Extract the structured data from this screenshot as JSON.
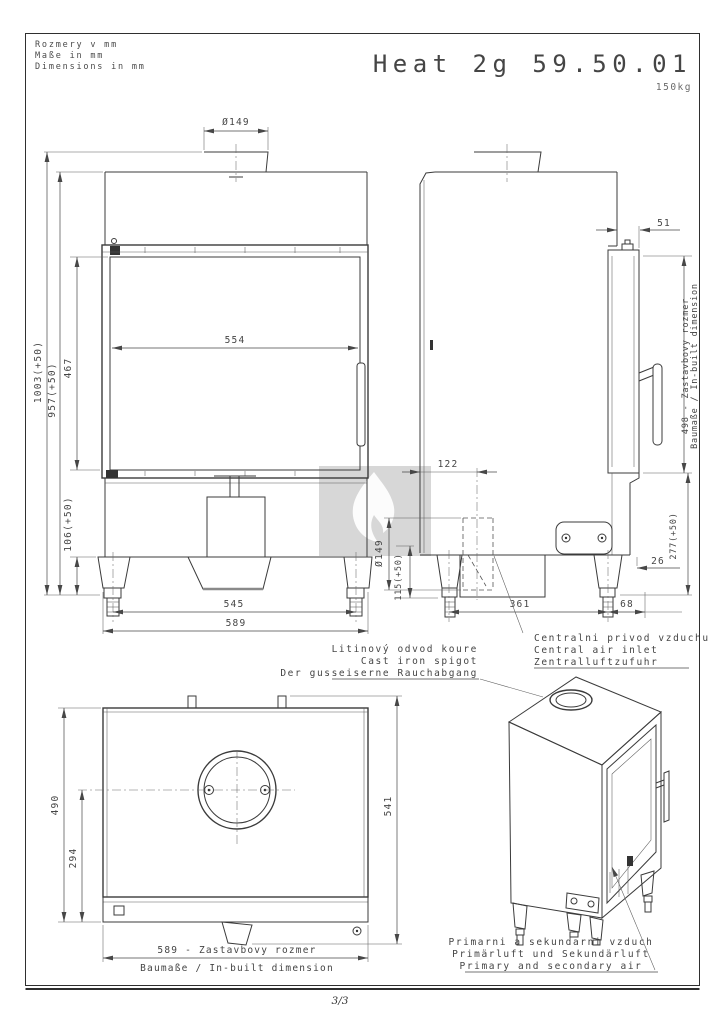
{
  "header": {
    "units": [
      "Rozmery v mm",
      "Maße in mm",
      "Dimensions in mm"
    ],
    "title": "Heat 2g 59.50.01",
    "weight": "150kg"
  },
  "front_view": {
    "dim_flue": "Ø149",
    "dim_glass_width": "554",
    "dim_h_total": "1003(+50)",
    "dim_h_body": "957(+50)",
    "dim_h_glass": "467",
    "dim_h_base": "106(+50)",
    "dim_feet": "545",
    "dim_width": "589"
  },
  "side_view": {
    "dim_top_offset": "51",
    "dim_inbuilt": "498 - Zastavbovy rozmer",
    "dim_inbuilt2": "Baumaße / In-built dimension",
    "dim_lower": "277(+50)",
    "dim_rear_gap": "26",
    "dim_flue_back": "122",
    "dim_air_dia": "Ø149",
    "dim_air_height": "115(+50)",
    "dim_legs": "361",
    "dim_rear_leg": "68"
  },
  "top_view": {
    "dim_depth": "490",
    "dim_flue_center": "294",
    "dim_depth_total": "541",
    "dim_width_line1": "589 - Zastavbovy rozmer",
    "dim_width_line2": "Baumaße / In-built dimension"
  },
  "callouts": {
    "spigot": [
      "Litinový odvod koure",
      "Cast iron spigot",
      "Der gusseiserne Rauchabgang"
    ],
    "central_air": [
      "Centralni privod vzduchu",
      "Central air inlet",
      "Zentralluftzufuhr"
    ],
    "primary_air": [
      "Primarni a sekundarni vzduch",
      "Primärluft und Sekundärluft",
      "Primary and secondary air"
    ]
  },
  "footer": {
    "page": "3/3"
  },
  "colors": {
    "title": "#a8a8a8",
    "watermark": "#d7d7d7",
    "flame": "#fcfcfc"
  }
}
